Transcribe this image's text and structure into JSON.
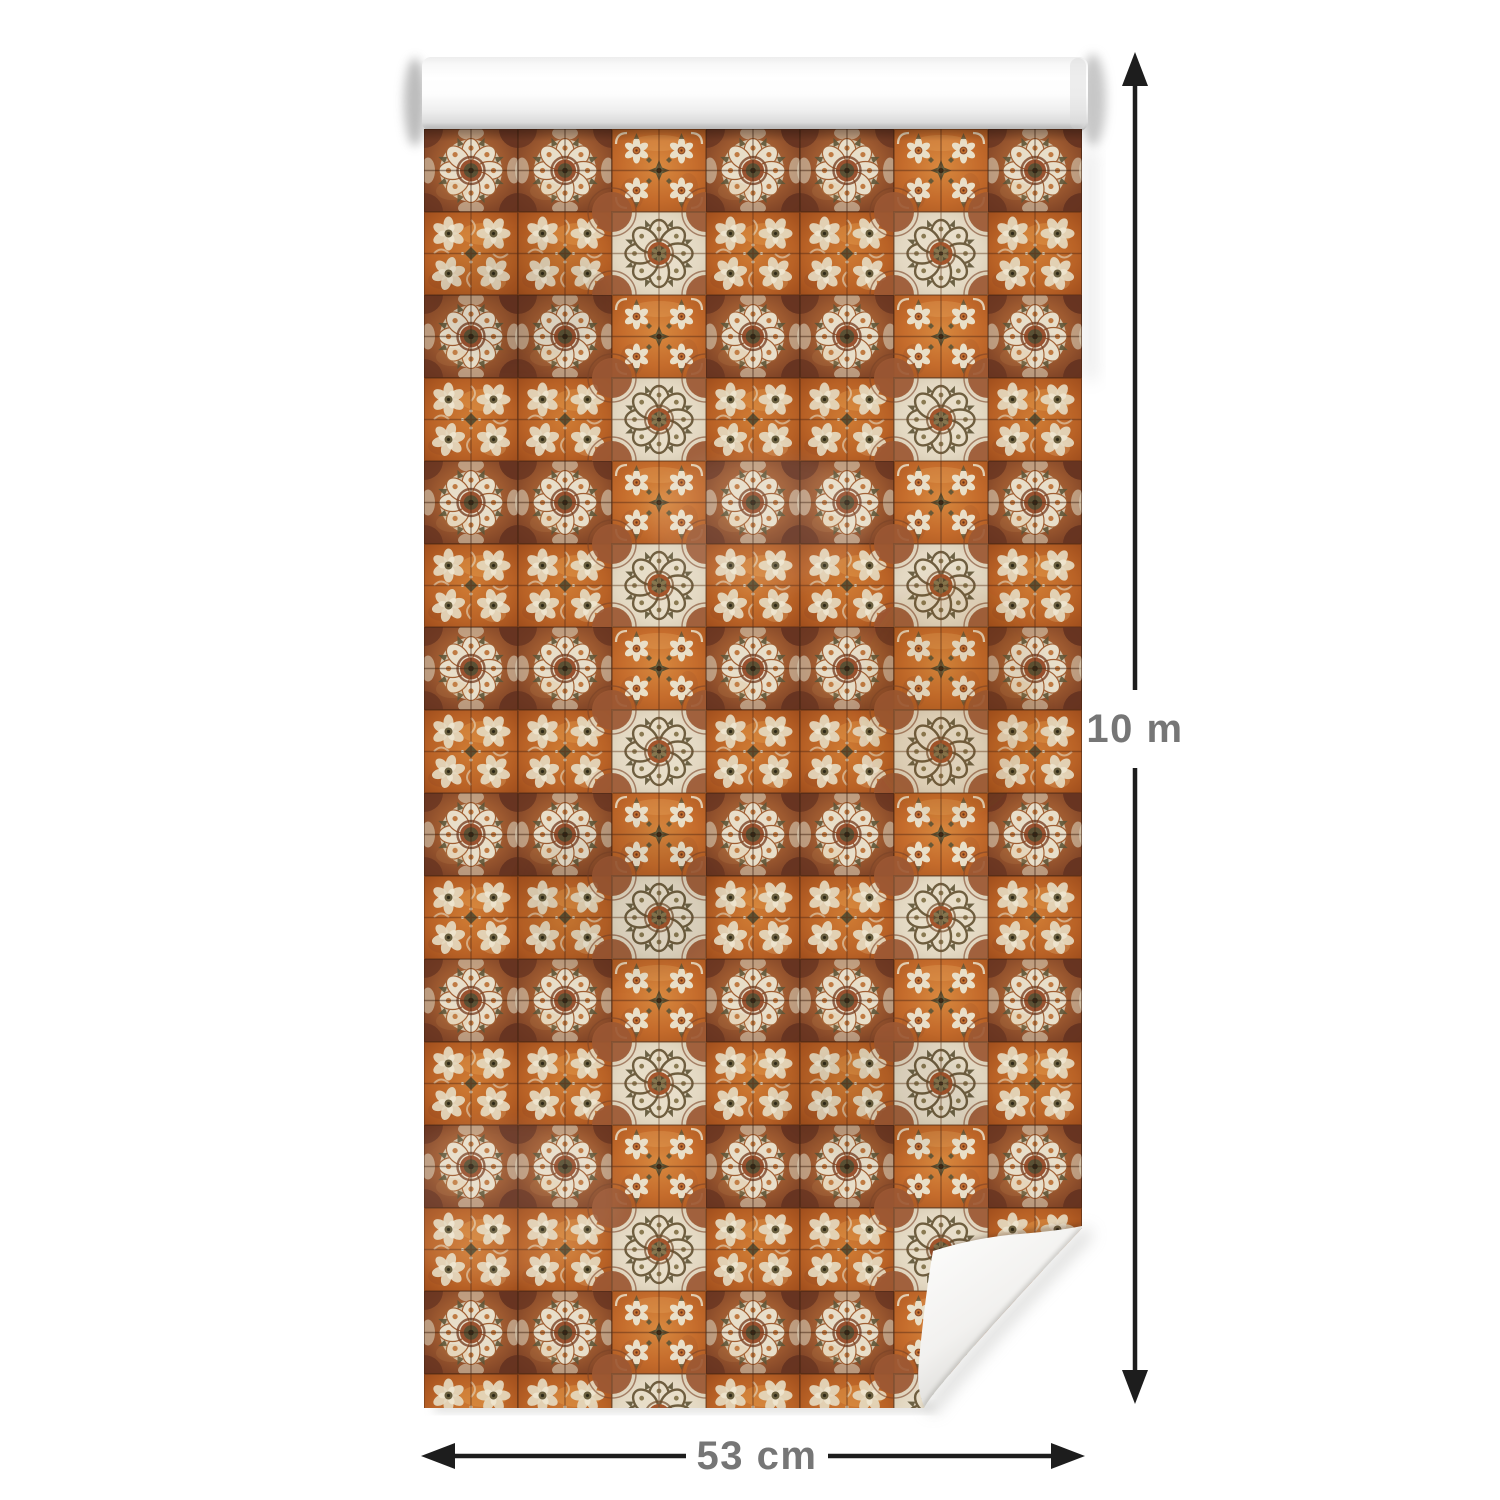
{
  "image": {
    "background_color": "#ffffff"
  },
  "wallpaper": {
    "roll_color": "#ffffff",
    "pattern_name": "vintage-orange-tiles",
    "grid": {
      "columns": 7,
      "rows": 15
    },
    "colors": {
      "cream": "#e8dec9",
      "orange": "#c96f2e",
      "terracotta": "#a15a30",
      "dark_brown": "#5f3118",
      "olive": "#5c5436"
    }
  },
  "dimensions": {
    "height": {
      "label": "10 m"
    },
    "width": {
      "label": "53 cm"
    },
    "arrow_color": "#1d1d1d",
    "label_color": "#767676"
  }
}
